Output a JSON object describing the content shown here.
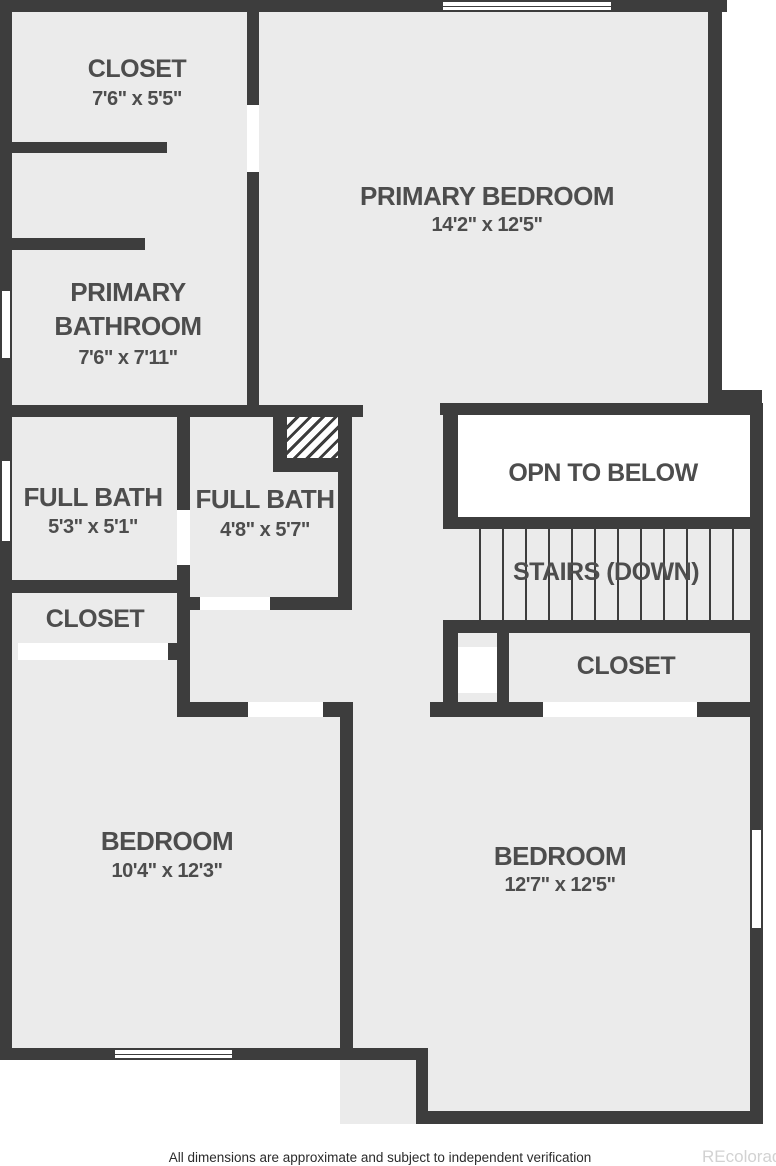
{
  "plan": {
    "rooms": {
      "closet_primary": {
        "label": "CLOSET",
        "dims": "7'6\" x 5'5\""
      },
      "primary_bedroom": {
        "label": "PRIMARY BEDROOM",
        "dims": "14'2\" x 12'5\""
      },
      "primary_bathroom": {
        "label_line1": "PRIMARY",
        "label_line2": "BATHROOM",
        "dims": "7'6\" x 7'11\""
      },
      "full_bath_left": {
        "label": "FULL BATH",
        "dims": "5'3\" x 5'1\""
      },
      "full_bath_mid": {
        "label": "FULL BATH",
        "dims": "4'8\" x 5'7\""
      },
      "open_to_below": {
        "label": "OPN TO BELOW"
      },
      "stairs": {
        "label": "STAIRS (DOWN)"
      },
      "closet_hall_left": {
        "label": "CLOSET"
      },
      "closet_hall_right": {
        "label": "CLOSET"
      },
      "bedroom_left": {
        "label": "BEDROOM",
        "dims": "10'4\" x 12'3\""
      },
      "bedroom_right": {
        "label": "BEDROOM",
        "dims": "12'7\" x 12'5\""
      }
    },
    "footer": {
      "disclaimer": "All dimensions are approximate and subject to independent verification"
    },
    "watermark": {
      "text": "REcolorado"
    },
    "colors": {
      "wall": "#3d3d3d",
      "room_fill": "#ebebeb",
      "open_fill": "#ffffff",
      "label": "#4d4d4d",
      "watermark": "#d2d2d2"
    }
  }
}
